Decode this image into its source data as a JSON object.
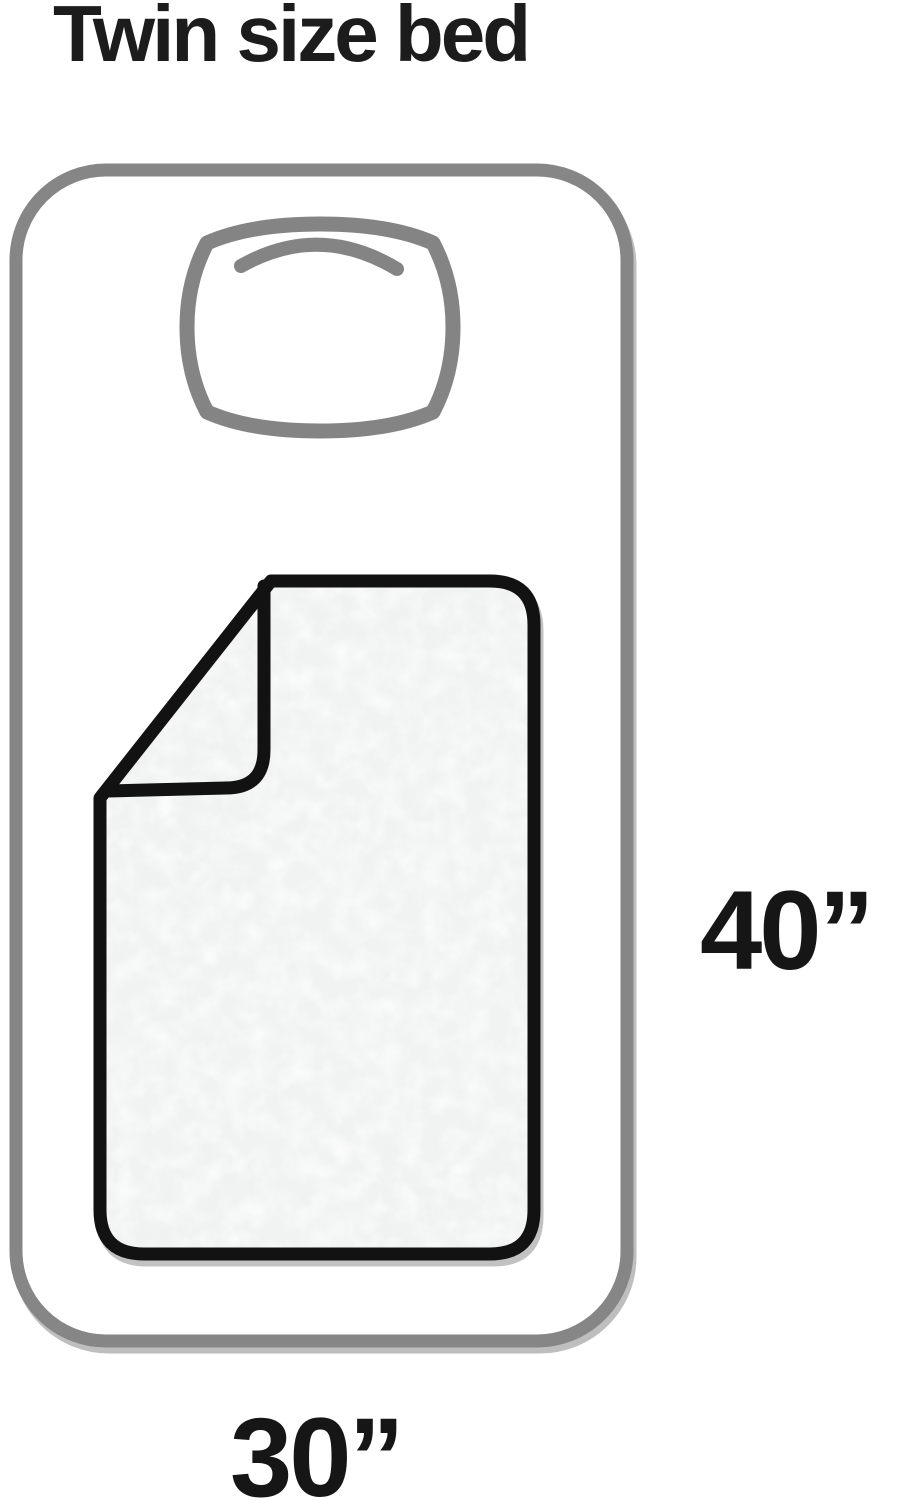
{
  "title": "Twin size bed",
  "dimensions": {
    "length_label": "40”",
    "width_label": "30”"
  },
  "icons": {
    "bed": "bed-outline-icon",
    "pillow": "pillow-icon",
    "blanket": "folded-blanket-icon"
  },
  "colors": {
    "bed_outline": "#868686",
    "pillow_outline": "#848484",
    "blanket_outline": "#121212",
    "blanket_fill": "#f1f2f2",
    "text": "#1c1c1c",
    "background": "#ffffff"
  }
}
